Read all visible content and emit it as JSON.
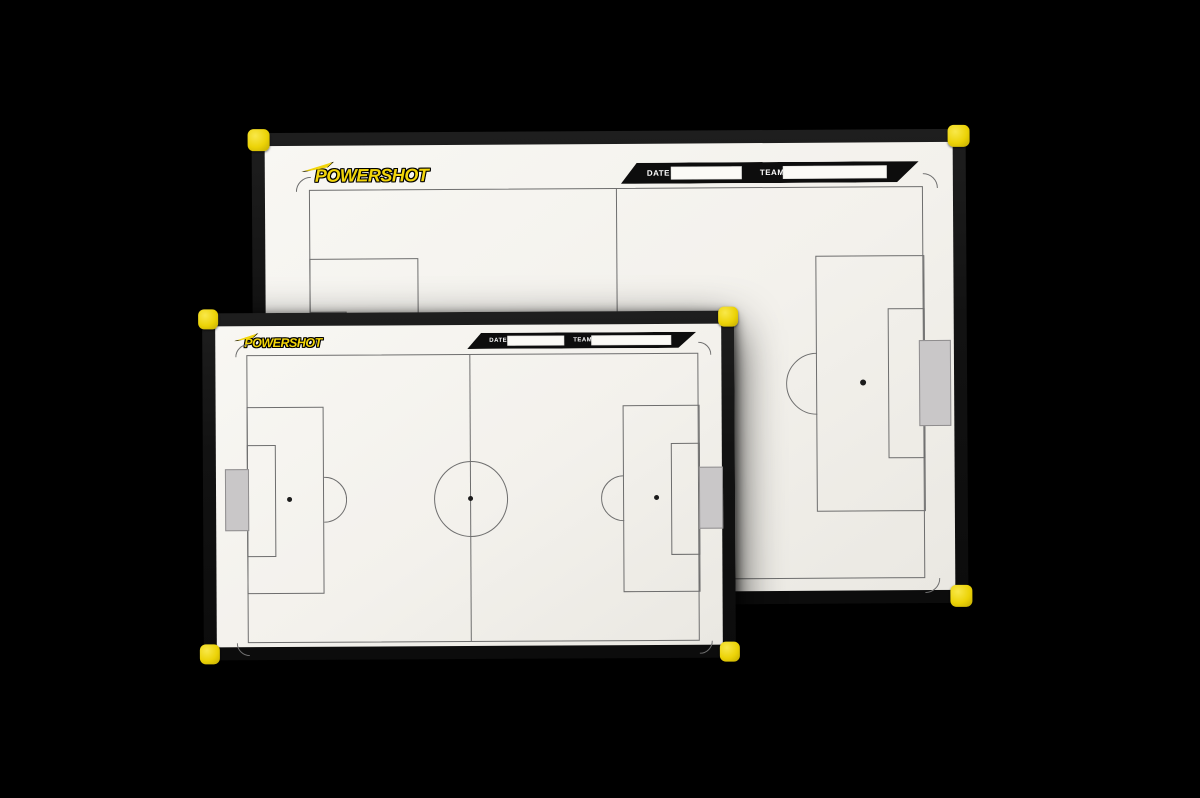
{
  "scene_background": "#000000",
  "colors": {
    "frame_black": "#141414",
    "board_surface": "#f3f1ec",
    "pitch_line": "#6e6e6e",
    "corner_yellow": "#ecd307",
    "goal_gray": "#c9c7c8",
    "banner_black": "#0d0d0d",
    "logo_yellow": "#f2d50a",
    "field_box_white": "#fbfaf6"
  },
  "back_board": {
    "brand": "POWERSHOT",
    "header": {
      "date_label": "DATE",
      "date_value": "",
      "team_label": "TEAM",
      "team_value": ""
    }
  },
  "front_board": {
    "brand": "POWERSHOT",
    "header": {
      "date_label": "DATE",
      "date_value": "",
      "team_label": "TEAM",
      "team_value": ""
    }
  }
}
